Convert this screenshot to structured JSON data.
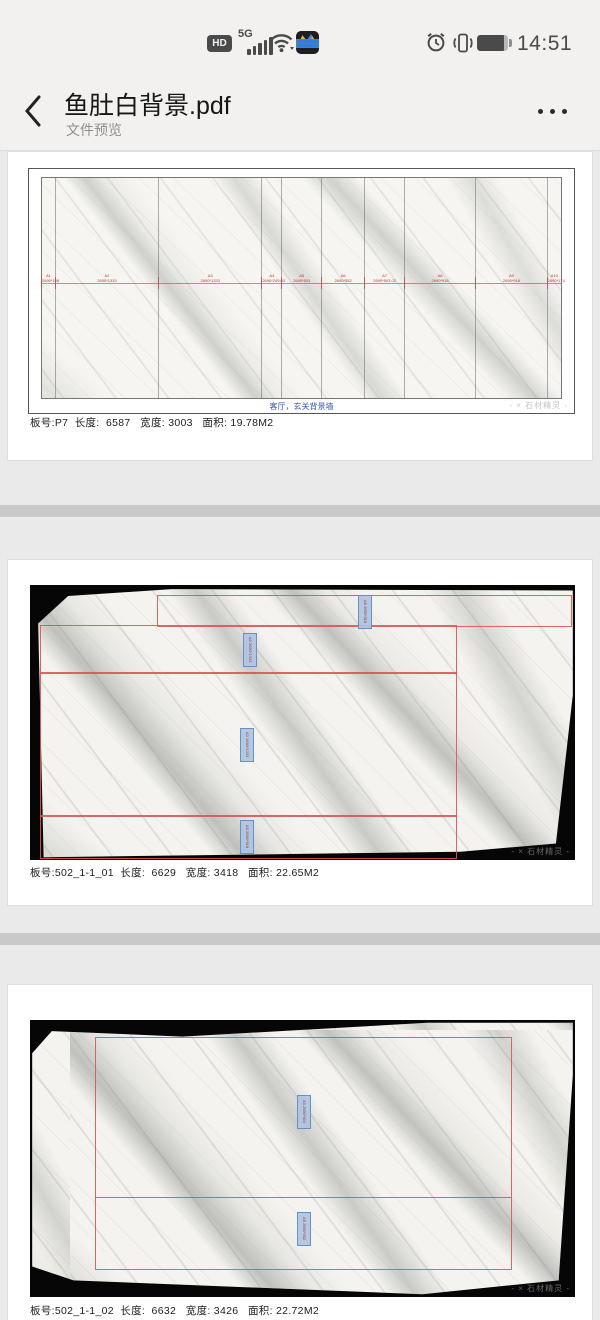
{
  "status_bar": {
    "hd_badge": "HD",
    "network_type": "5G",
    "time": "14:51"
  },
  "header": {
    "title": "鱼肚白背景.pdf",
    "subtitle": "文件预览"
  },
  "page1": {
    "caption": "客厅，玄关背景墙",
    "info": "板号:P7  长度:  6587   宽度: 3003   面积: 19.78M2",
    "watermark": "- × 石材精灵 -",
    "panels": [
      {
        "id": "A1",
        "dim": "2690*168"
      },
      {
        "id": "A2",
        "dim": "2690*1333"
      },
      {
        "id": "A3",
        "dim": "2690*1333"
      },
      {
        "id": "A4",
        "dim": "2690*249.03"
      },
      {
        "id": "A5",
        "dim": "2690*503"
      },
      {
        "id": "A6",
        "dim": "2690*552"
      },
      {
        "id": "A7",
        "dim": "2690*503.02"
      },
      {
        "id": "A8",
        "dim": "2690*918"
      },
      {
        "id": "A9",
        "dim": "2690*918"
      },
      {
        "id": "A10",
        "dim": "2690*174"
      }
    ]
  },
  "page2": {
    "info": "板号:502_1-1_01  长度:  6629   宽度: 3418   面积: 22.65M2",
    "watermark": "- × 石材精灵 -",
    "tags": [
      "A8 2690*918",
      "A2 2690*1333",
      "A3 2690*1333",
      "A9 2690*918"
    ]
  },
  "page3": {
    "info": "板号:502_1-1_02  长度:  6632   宽度: 3426   面积: 22.72M2",
    "watermark": "- × 石材精灵 -",
    "tags": [
      "A5 2690*503",
      "A6 2690*552"
    ]
  }
}
